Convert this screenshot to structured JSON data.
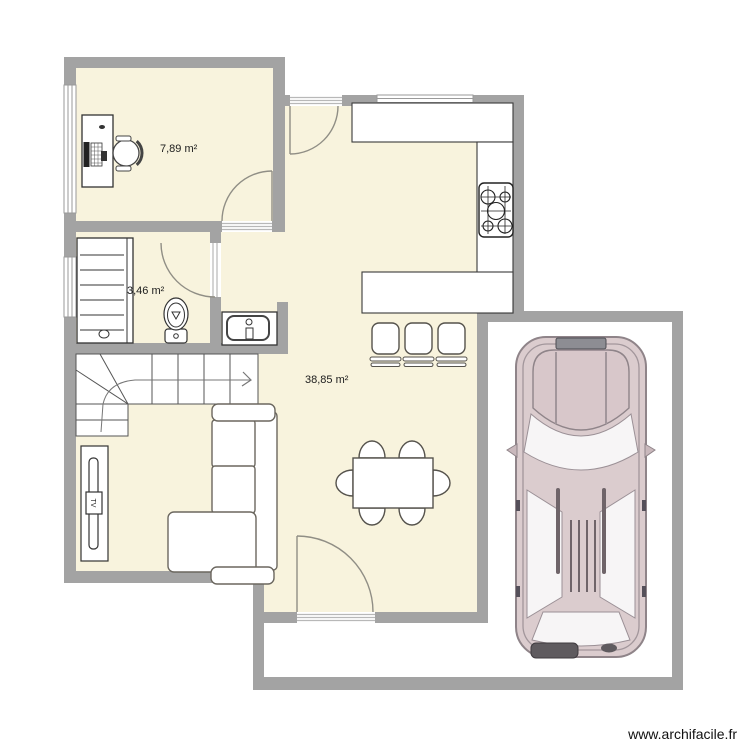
{
  "page": {
    "watermark": "www.archifacile.fr",
    "background": "#ffffff"
  },
  "plan": {
    "rooms": [
      {
        "id": "office",
        "area_label": "7,89 m²"
      },
      {
        "id": "bathroom",
        "area_label": "3,46 m²"
      },
      {
        "id": "living-kitchen",
        "area_label": "38,85 m²"
      }
    ],
    "tv_label": "TV",
    "icons": [
      "desk-icon",
      "office-chair-icon",
      "shelving-icon",
      "toilet-icon",
      "washbasin-icon",
      "staircase-icon",
      "tv-unit-icon",
      "corner-sofa-icon",
      "dining-table-icon",
      "dining-chair-icon",
      "bar-stool-icon",
      "kitchen-counter-icon",
      "gas-hob-icon",
      "car-icon",
      "door-arc-icon",
      "window-icon"
    ],
    "colors": {
      "wall": "#a3a3a3",
      "room_fill": "#f8f3dd",
      "furniture_outline": "#55524c",
      "counter_outline": "#3a3a3a",
      "car_body": "#dbccce",
      "car_detail": "#6f6469"
    }
  }
}
